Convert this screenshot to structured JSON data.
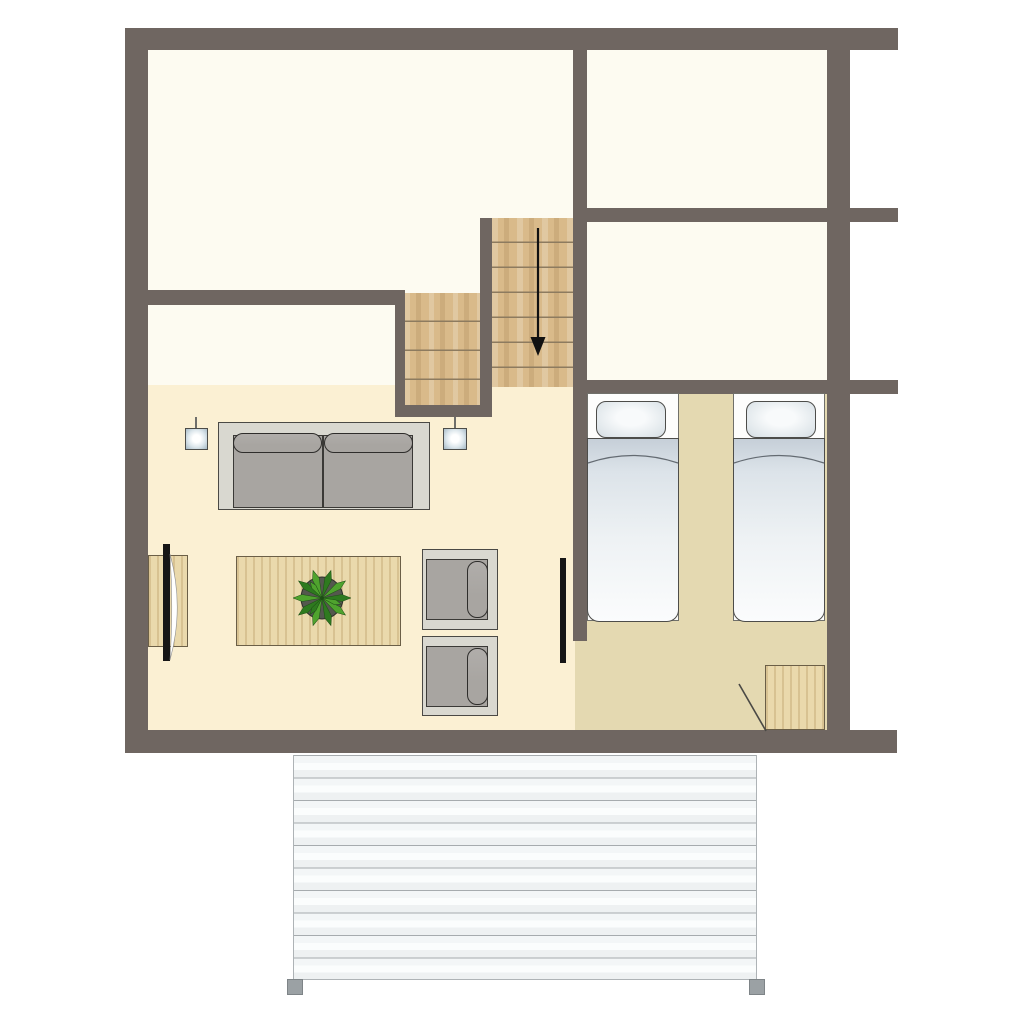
{
  "document": {
    "type": "architectural floor plan, top-down view",
    "visible_text": [],
    "canvas": "1024x1024"
  },
  "colors": {
    "wall": "#6F6661",
    "room_white": "#FDFBF1",
    "living_floor": "#FBF0D3",
    "bedroom_floor": "#E4D9B1",
    "stair_wood": "#D9BA8A",
    "tread_line": "#8D7B5F",
    "table_wood": "#EAD9AC",
    "furniture_frame": "#D9D8D0",
    "cushion": "#A8A5A1",
    "outline": "#4A4945",
    "deck_post": "#9BA1A4",
    "deck_line": "#A6ABAE",
    "tv_black": "#161616",
    "duvet_top": "#C6CFD8",
    "duvet_bottom": "#FBFCFD",
    "plant_green_dark": "#2E7A1F",
    "plant_green_light": "#4FA32E",
    "plant_pot": "#54584E",
    "arrow_black": "#111111"
  },
  "rooms": [
    {
      "name": "top-left-room",
      "floor": "white"
    },
    {
      "name": "small-hall-room",
      "floor": "white"
    },
    {
      "name": "top-right-upper-room",
      "floor": "white"
    },
    {
      "name": "top-right-lower-room",
      "floor": "white"
    },
    {
      "name": "living-room",
      "floor": "cream"
    },
    {
      "name": "bedroom",
      "floor": "tan"
    }
  ],
  "stairs": {
    "flights": 2,
    "lower_flight_treads": 4,
    "upper_flight_treads": 7,
    "direction_arrow": "down"
  },
  "furniture": [
    "sofa with two seat cushions and two back cushions",
    "pendant light left",
    "pendant light right",
    "tv cabinet with tv on left wall",
    "coffee table with potted plant",
    "armchair upper",
    "armchair lower",
    "wall tv on bedroom divider",
    "single bed left with pillow and duvet",
    "single bed right with pillow and duvet",
    "corner closet with open door swing"
  ],
  "deck": {
    "planks": 10,
    "posts": 2
  }
}
